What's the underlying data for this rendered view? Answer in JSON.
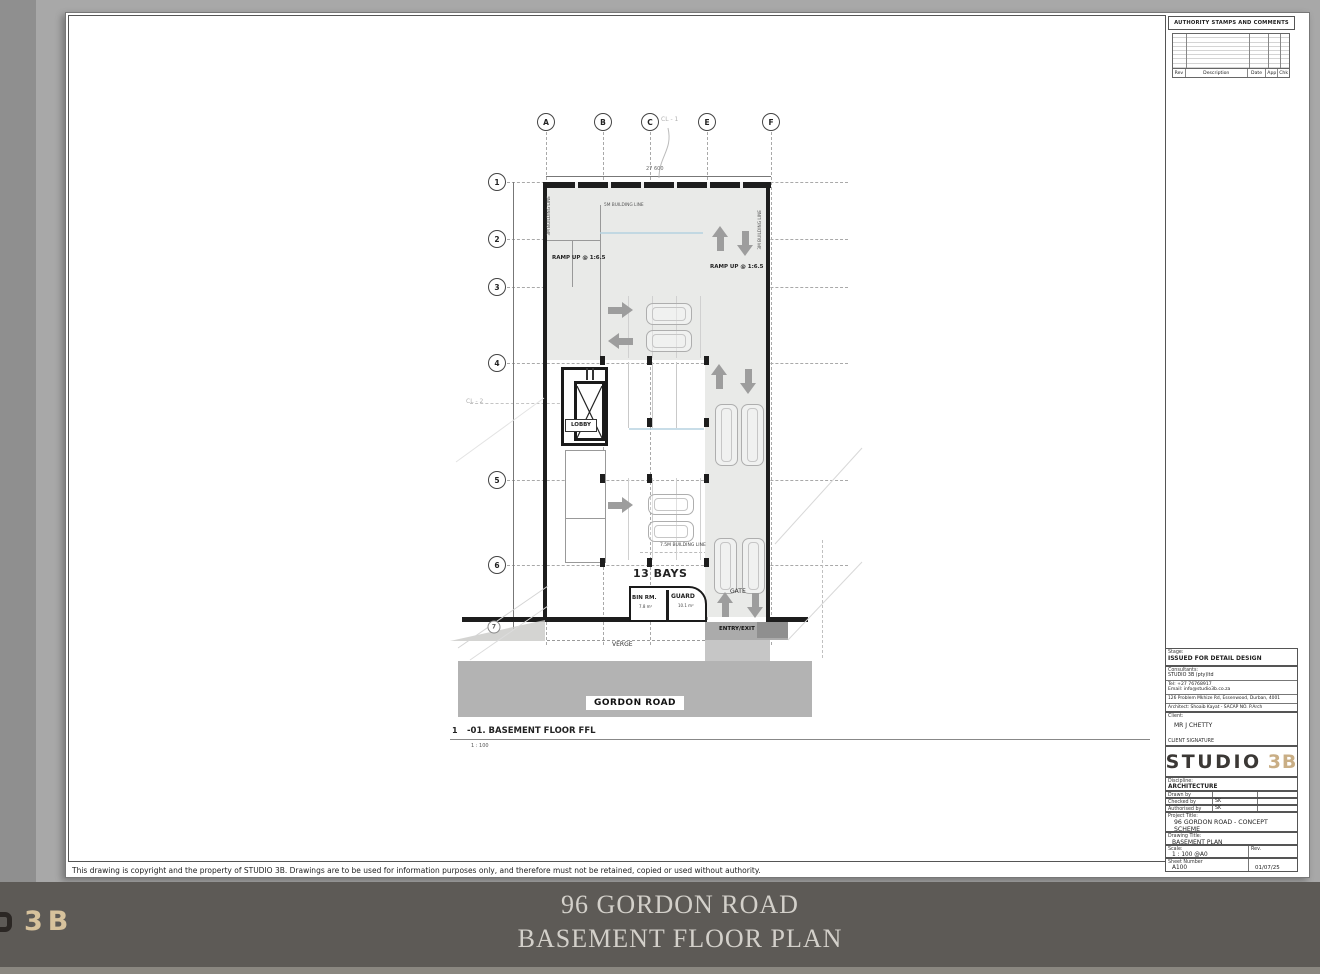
{
  "colors": {
    "page_background": "#A8A8A8",
    "footer_background": "#5D5A56",
    "footer_text": "#D3D0CA",
    "logo_tan": "#C9AE85",
    "plan_gray": "#E9EAE8",
    "road_gray": "#B3B3B3",
    "arrow_gray": "#9D9D9D"
  },
  "copyright": "This drawing is copyright and the property of STUDIO 3B. Drawings are to be used for information purposes only, and therefore must not be retained, copied or used without authority.",
  "footer": {
    "line1": "96 GORDON ROAD",
    "line2": "BASEMENT FLOOR PLAN",
    "logo_3b": "3B"
  },
  "titleblock": {
    "authority_title": "AUTHORITY STAMPS AND COMMENTS",
    "authority_headers": [
      "Rev",
      "Description",
      "Date",
      "App",
      "Chk"
    ],
    "stage_label": "Stage:",
    "stage_value": "ISSUED FOR DETAIL DESIGN",
    "consultants_label": "Consultants:",
    "consultants_name": "STUDIO 3B (pty)ltd",
    "tel": "Tel: +27 76768917",
    "email": "Email: info@studio3b.co.za",
    "address": "126 Problem Mkhize Rd, Essenwood, Durban, 4001",
    "architect": "Architect: Shoaib Kayat - SACAP NO. P.Arch",
    "client_label": "Client:",
    "client_value": "MR J CHETTY",
    "client_signature": "CLIENT SIGNATURE",
    "logo_studio": "STUDIO",
    "logo_3b": "3B",
    "discipline_label": "Discipline:",
    "discipline_value": "ARCHITECTURE",
    "drawn_label": "Drawn by",
    "drawn_value": "",
    "checked_label": "Checked by",
    "checked_value": "SK",
    "authorised_label": "Authorised by",
    "authorised_value": "SK",
    "project_label": "Project Title:",
    "project_value": "96 GORDON ROAD - CONCEPT SCHEME",
    "drawing_label": "Drawing Title:",
    "drawing_value": "BASEMENT PLAN",
    "scale_label": "Scale:",
    "scale_value": "1 : 100 @A0",
    "rev_label": "Rev.",
    "sheet_label": "Sheet Number",
    "sheet_value": "A100",
    "date_value": "01/07/25"
  },
  "plan": {
    "columns": [
      "A",
      "B",
      "C",
      "E",
      "F"
    ],
    "rows": [
      "1",
      "2",
      "3",
      "4",
      "5",
      "6",
      "7"
    ],
    "cl1": "CL - 1",
    "cl2": "CL - 2",
    "top_dim": "27 600",
    "labels": {
      "ramp_left": "RAMP UP @ 1:6.5",
      "ramp_right": "RAMP UP @ 1:6.5",
      "bl3_left": "3M BUILDING LINE",
      "bl3_right": "3M BUILDING LINE",
      "bl5": "5M BUILDING LINE",
      "bl75": "7.5M BUILDING LINE",
      "lobby": "LOBBY",
      "bays": "13 BAYS",
      "bin": "BIN RM.",
      "bin_area": "7.8 m²",
      "guard": "GUARD",
      "guard_area": "10.1 m²",
      "gate": "GATE",
      "entry_exit": "ENTRY/EXIT",
      "verge": "VERGE",
      "road": "GORDON ROAD"
    },
    "view": {
      "number": "1",
      "title": "-01. BASEMENT FLOOR FFL",
      "scale": "1 : 100"
    }
  }
}
